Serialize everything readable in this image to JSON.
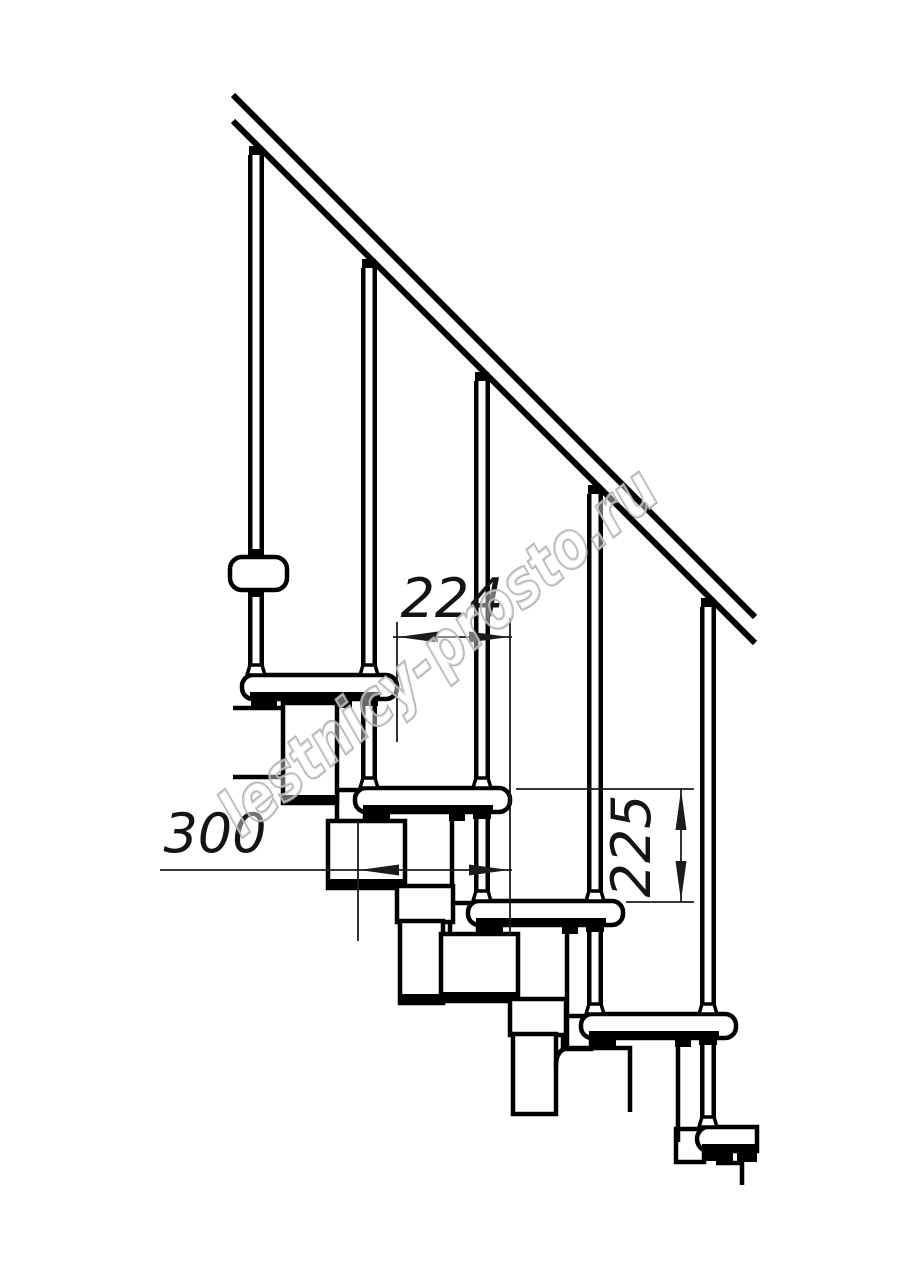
{
  "page": {
    "background": "#ffffff"
  },
  "drawing": {
    "type": "modular staircase side-view technical drawing",
    "watermark": "lestnicy-prosto.ru",
    "dimensions": {
      "going_mm": "224",
      "tread_depth_mm": "300",
      "riser_height_mm": "225"
    },
    "colors": {
      "line": "#000000",
      "dimension": "#1b1b1b",
      "watermark_outline": "#a9a9a9",
      "background": "#ffffff"
    }
  }
}
